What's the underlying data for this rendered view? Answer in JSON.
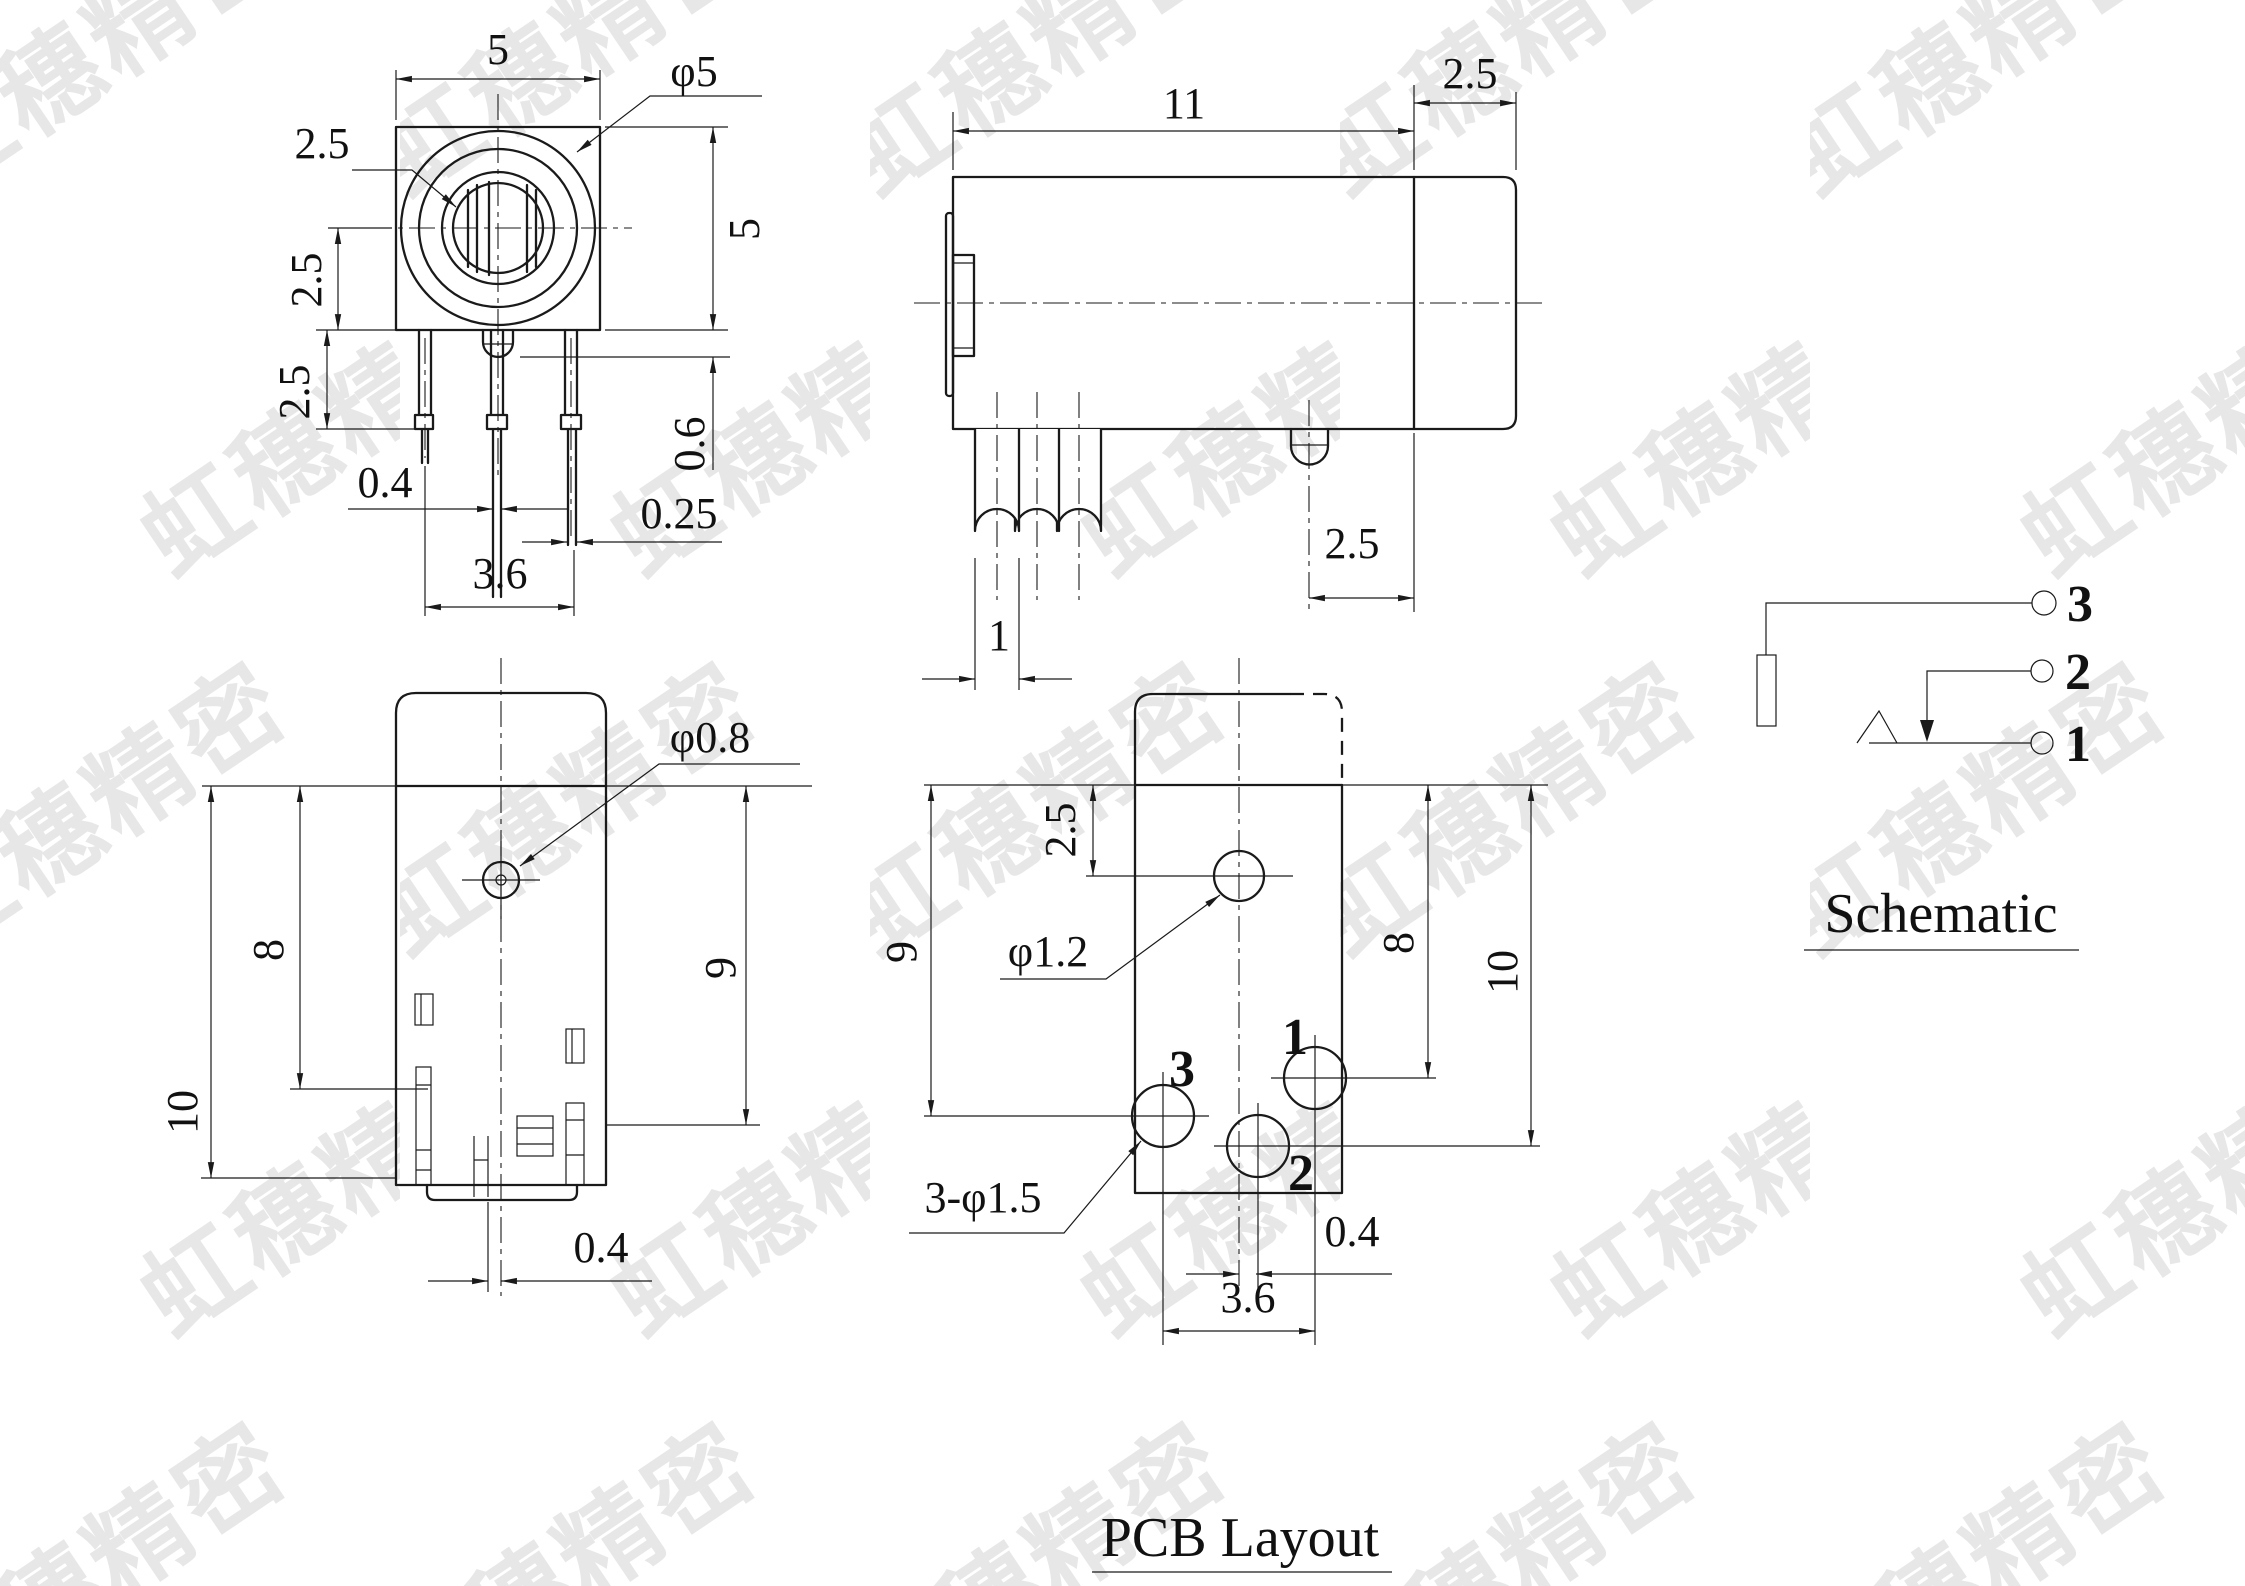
{
  "watermark": {
    "text": "虹穗精密",
    "color": "#e7e7e7"
  },
  "colors": {
    "line": "#1a1a1a",
    "background": "#ffffff"
  },
  "front_view": {
    "dim_body_width": "5",
    "dim_outer_dia": "φ5",
    "dim_inner_dia": "2.5",
    "dim_body_height": "5",
    "dim_center_to_bottom": "2.5",
    "dim_shoulder_len": "2.5",
    "dim_pin_width": "0.4",
    "dim_pin_span": "3.6",
    "dim_pin_thickness": "0.25",
    "dim_boss_height": "0.6"
  },
  "side_view": {
    "dim_body_length": "11",
    "dim_barrel_length": "2.5",
    "dim_pin_width": "1",
    "dim_boss_offset": "2.5"
  },
  "bottom_view": {
    "dim_overall_height": "10",
    "dim_slot_height": "8",
    "dim_body_height": "9",
    "dim_hole_dia": "φ0.8",
    "dim_tab_offset": "0.4"
  },
  "pcb_view": {
    "title": "PCB Layout",
    "dim_hole_offset": "2.5",
    "dim_hole_dia": "φ1.2",
    "dim_pad1_y": "8",
    "dim_pad2_y": "10",
    "dim_pad3_y": "9",
    "note_pad_dia": "3-φ1.5",
    "dim_pad2_x": "0.4",
    "dim_pad_pitch": "3.6",
    "pad1_label": "1",
    "pad2_label": "2",
    "pad3_label": "3"
  },
  "schematic_view": {
    "title": "Schematic",
    "pin1_label": "1",
    "pin2_label": "2",
    "pin3_label": "3"
  }
}
